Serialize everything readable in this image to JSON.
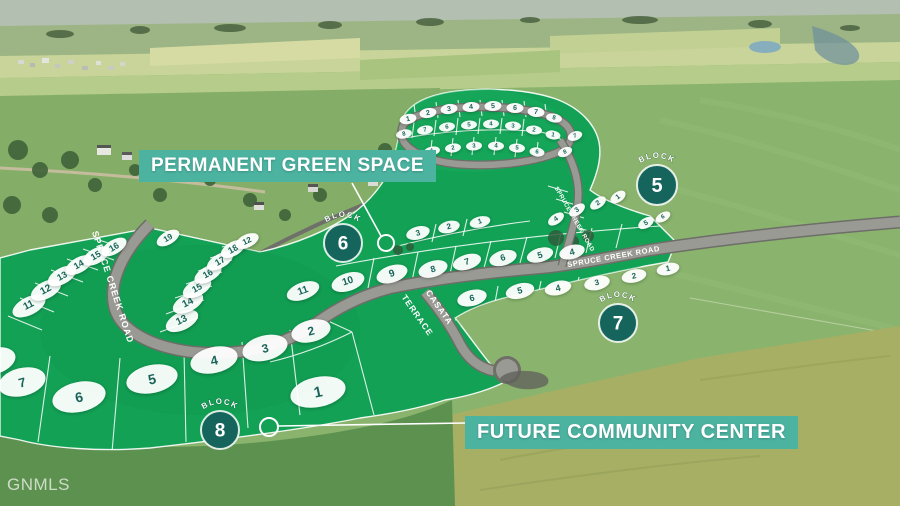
{
  "watermark": "GNMLS",
  "labels": {
    "green_space": "PERMANENT GREEN SPACE",
    "community_center": "FUTURE COMMUNITY CENTER"
  },
  "roads": {
    "west": "SPRUCE CREEK ROAD",
    "east": "SPRUCE CREEK ROAD",
    "upper": "SPRUCE CREEK ROAD",
    "casata_line1": "CASATA",
    "casata_line2": "TERRACE"
  },
  "colors": {
    "banner": "#4db3a1",
    "block_circle": "#15655c",
    "plat_green": "#12a155",
    "lot_number": "#1a6459"
  },
  "blocks": [
    {
      "label": "BLOCK",
      "number": "5",
      "x": 657,
      "y": 185,
      "r": 20
    },
    {
      "label": "BLOCK",
      "number": "6",
      "x": 343,
      "y": 243,
      "r": 19
    },
    {
      "label": "BLOCK",
      "number": "7",
      "x": 618,
      "y": 323,
      "r": 19
    },
    {
      "label": "BLOCK",
      "number": "8",
      "x": 220,
      "y": 430,
      "r": 19
    }
  ],
  "lots": [
    {
      "n": "1",
      "x": 318,
      "y": 392,
      "w": 56,
      "h": 30,
      "rot": -12,
      "fs": 15
    },
    {
      "n": "2",
      "x": 311,
      "y": 331,
      "w": 40,
      "h": 22,
      "rot": -14,
      "fs": 12
    },
    {
      "n": "3",
      "x": 265,
      "y": 348,
      "w": 46,
      "h": 25,
      "rot": -14,
      "fs": 12
    },
    {
      "n": "4",
      "x": 214,
      "y": 360,
      "w": 48,
      "h": 26,
      "rot": -13,
      "fs": 13
    },
    {
      "n": "5",
      "x": 152,
      "y": 379,
      "w": 52,
      "h": 28,
      "rot": -12,
      "fs": 14
    },
    {
      "n": "6",
      "x": 79,
      "y": 397,
      "w": 54,
      "h": 30,
      "rot": -12,
      "fs": 14
    },
    {
      "n": "7",
      "x": 22,
      "y": 382,
      "w": 48,
      "h": 28,
      "rot": -14,
      "fs": 13
    },
    {
      "n": "8",
      "x": -6,
      "y": 361,
      "w": 44,
      "h": 26,
      "rot": -16,
      "fs": 12
    },
    {
      "n": "11",
      "x": 29,
      "y": 306,
      "w": 36,
      "h": 18,
      "rot": -27,
      "fs": 10
    },
    {
      "n": "12",
      "x": 46,
      "y": 290,
      "w": 33,
      "h": 17,
      "rot": -28,
      "fs": 10
    },
    {
      "n": "13",
      "x": 62,
      "y": 276,
      "w": 31,
      "h": 16,
      "rot": -29,
      "fs": 9
    },
    {
      "n": "14",
      "x": 79,
      "y": 265,
      "w": 30,
      "h": 15,
      "rot": -30,
      "fs": 9
    },
    {
      "n": "15",
      "x": 96,
      "y": 256,
      "w": 29,
      "h": 15,
      "rot": -30,
      "fs": 9
    },
    {
      "n": "16",
      "x": 114,
      "y": 247,
      "w": 28,
      "h": 14,
      "rot": -31,
      "fs": 9
    },
    {
      "n": "13",
      "x": 182,
      "y": 321,
      "w": 35,
      "h": 18,
      "rot": -26,
      "fs": 10
    },
    {
      "n": "14",
      "x": 188,
      "y": 303,
      "w": 33,
      "h": 17,
      "rot": -27,
      "fs": 10
    },
    {
      "n": "15",
      "x": 197,
      "y": 288,
      "w": 31,
      "h": 16,
      "rot": -28,
      "fs": 9
    },
    {
      "n": "16",
      "x": 208,
      "y": 274,
      "w": 30,
      "h": 15,
      "rot": -29,
      "fs": 9
    },
    {
      "n": "17",
      "x": 220,
      "y": 261,
      "w": 29,
      "h": 14,
      "rot": -30,
      "fs": 9
    },
    {
      "n": "18",
      "x": 233,
      "y": 249,
      "w": 27,
      "h": 14,
      "rot": -30,
      "fs": 9
    },
    {
      "n": "19",
      "x": 168,
      "y": 238,
      "w": 25,
      "h": 13,
      "rot": -30,
      "fs": 8
    },
    {
      "n": "12",
      "x": 247,
      "y": 241,
      "w": 25,
      "h": 13,
      "rot": -25,
      "fs": 8
    },
    {
      "n": "11",
      "x": 303,
      "y": 291,
      "w": 34,
      "h": 17,
      "rot": -20,
      "fs": 10
    },
    {
      "n": "10",
      "x": 348,
      "y": 282,
      "w": 34,
      "h": 18,
      "rot": -18,
      "fs": 10
    },
    {
      "n": "9",
      "x": 392,
      "y": 274,
      "w": 32,
      "h": 17,
      "rot": -18,
      "fs": 10
    },
    {
      "n": "8",
      "x": 433,
      "y": 269,
      "w": 30,
      "h": 16,
      "rot": -17,
      "fs": 9
    },
    {
      "n": "7",
      "x": 467,
      "y": 262,
      "w": 29,
      "h": 15,
      "rot": -17,
      "fs": 9
    },
    {
      "n": "6",
      "x": 503,
      "y": 258,
      "w": 28,
      "h": 15,
      "rot": -16,
      "fs": 9
    },
    {
      "n": "5",
      "x": 540,
      "y": 255,
      "w": 27,
      "h": 14,
      "rot": -16,
      "fs": 9
    },
    {
      "n": "4",
      "x": 572,
      "y": 252,
      "w": 26,
      "h": 14,
      "rot": -15,
      "fs": 9
    },
    {
      "n": "3",
      "x": 418,
      "y": 233,
      "w": 24,
      "h": 13,
      "rot": -15,
      "fs": 8
    },
    {
      "n": "2",
      "x": 449,
      "y": 227,
      "w": 22,
      "h": 12,
      "rot": -14,
      "fs": 8
    },
    {
      "n": "1",
      "x": 480,
      "y": 222,
      "w": 21,
      "h": 11,
      "rot": -14,
      "fs": 7
    },
    {
      "n": "6",
      "x": 472,
      "y": 298,
      "w": 30,
      "h": 16,
      "rot": -14,
      "fs": 9
    },
    {
      "n": "5",
      "x": 520,
      "y": 291,
      "w": 29,
      "h": 15,
      "rot": -14,
      "fs": 9
    },
    {
      "n": "4",
      "x": 558,
      "y": 288,
      "w": 27,
      "h": 14,
      "rot": -13,
      "fs": 9
    },
    {
      "n": "3",
      "x": 597,
      "y": 283,
      "w": 26,
      "h": 14,
      "rot": -13,
      "fs": 8
    },
    {
      "n": "2",
      "x": 634,
      "y": 276,
      "w": 25,
      "h": 13,
      "rot": -12,
      "fs": 8
    },
    {
      "n": "1",
      "x": 668,
      "y": 269,
      "w": 23,
      "h": 12,
      "rot": -12,
      "fs": 8
    },
    {
      "n": "1",
      "x": 408,
      "y": 119,
      "w": 17,
      "h": 10,
      "rot": -12,
      "fs": 7
    },
    {
      "n": "2",
      "x": 428,
      "y": 113,
      "w": 17,
      "h": 10,
      "rot": -10,
      "fs": 7
    },
    {
      "n": "3",
      "x": 449,
      "y": 109,
      "w": 17,
      "h": 10,
      "rot": -8,
      "fs": 7
    },
    {
      "n": "4",
      "x": 471,
      "y": 107,
      "w": 17,
      "h": 10,
      "rot": -5,
      "fs": 7
    },
    {
      "n": "5",
      "x": 493,
      "y": 106,
      "w": 17,
      "h": 10,
      "rot": -3,
      "fs": 7
    },
    {
      "n": "6",
      "x": 515,
      "y": 108,
      "w": 17,
      "h": 10,
      "rot": 2,
      "fs": 7
    },
    {
      "n": "7",
      "x": 536,
      "y": 112,
      "w": 17,
      "h": 10,
      "rot": 6,
      "fs": 7
    },
    {
      "n": "8",
      "x": 554,
      "y": 118,
      "w": 16,
      "h": 9,
      "rot": 10,
      "fs": 6
    },
    {
      "n": "8",
      "x": 404,
      "y": 134,
      "w": 16,
      "h": 9,
      "rot": -12,
      "fs": 6
    },
    {
      "n": "7",
      "x": 425,
      "y": 130,
      "w": 16,
      "h": 9,
      "rot": -10,
      "fs": 6
    },
    {
      "n": "6",
      "x": 447,
      "y": 127,
      "w": 16,
      "h": 9,
      "rot": -8,
      "fs": 6
    },
    {
      "n": "5",
      "x": 469,
      "y": 125,
      "w": 16,
      "h": 9,
      "rot": -5,
      "fs": 6
    },
    {
      "n": "4",
      "x": 491,
      "y": 124,
      "w": 16,
      "h": 9,
      "rot": -3,
      "fs": 6
    },
    {
      "n": "3",
      "x": 513,
      "y": 126,
      "w": 16,
      "h": 9,
      "rot": 2,
      "fs": 6
    },
    {
      "n": "2",
      "x": 534,
      "y": 130,
      "w": 16,
      "h": 9,
      "rot": 6,
      "fs": 6
    },
    {
      "n": "1",
      "x": 553,
      "y": 135,
      "w": 15,
      "h": 9,
      "rot": 10,
      "fs": 6
    },
    {
      "n": "1",
      "x": 432,
      "y": 151,
      "w": 16,
      "h": 9,
      "rot": -10,
      "fs": 6
    },
    {
      "n": "2",
      "x": 453,
      "y": 148,
      "w": 16,
      "h": 9,
      "rot": -7,
      "fs": 6
    },
    {
      "n": "3",
      "x": 474,
      "y": 146,
      "w": 16,
      "h": 9,
      "rot": -4,
      "fs": 6
    },
    {
      "n": "4",
      "x": 496,
      "y": 146,
      "w": 16,
      "h": 9,
      "rot": 0,
      "fs": 6
    },
    {
      "n": "5",
      "x": 517,
      "y": 148,
      "w": 16,
      "h": 9,
      "rot": 4,
      "fs": 6
    },
    {
      "n": "6",
      "x": 537,
      "y": 152,
      "w": 15,
      "h": 9,
      "rot": 8,
      "fs": 6
    },
    {
      "n": "4",
      "x": 556,
      "y": 219,
      "w": 18,
      "h": 10,
      "rot": -35,
      "fs": 7
    },
    {
      "n": "3",
      "x": 577,
      "y": 210,
      "w": 18,
      "h": 10,
      "rot": -35,
      "fs": 7
    },
    {
      "n": "2",
      "x": 598,
      "y": 203,
      "w": 18,
      "h": 10,
      "rot": -35,
      "fs": 7
    },
    {
      "n": "1",
      "x": 618,
      "y": 197,
      "w": 17,
      "h": 10,
      "rot": -35,
      "fs": 7
    },
    {
      "n": "5",
      "x": 646,
      "y": 223,
      "w": 17,
      "h": 10,
      "rot": -30,
      "fs": 7
    },
    {
      "n": "6",
      "x": 663,
      "y": 217,
      "w": 16,
      "h": 9,
      "rot": -30,
      "fs": 6
    },
    {
      "n": "7",
      "x": 575,
      "y": 136,
      "w": 15,
      "h": 9,
      "rot": -20,
      "fs": 6
    },
    {
      "n": "8",
      "x": 565,
      "y": 152,
      "w": 15,
      "h": 9,
      "rot": -25,
      "fs": 6
    }
  ]
}
